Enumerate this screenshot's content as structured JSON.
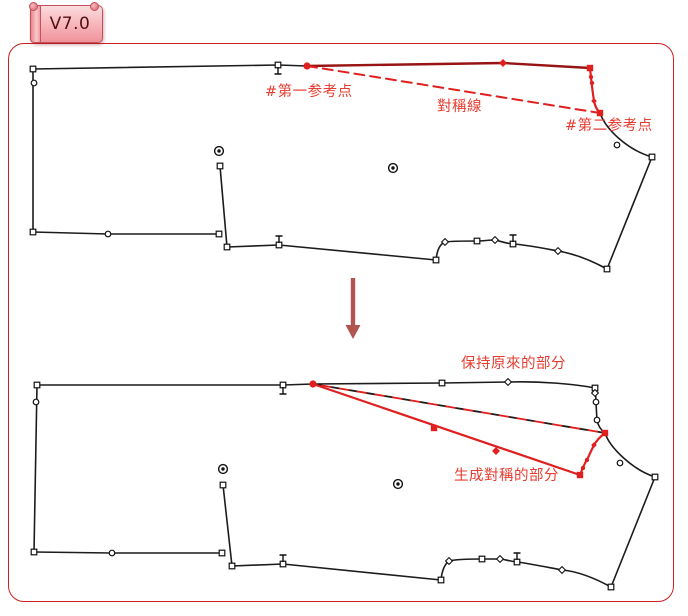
{
  "badge": {
    "version_label": "V7.0"
  },
  "diagram": {
    "top_pattern": {
      "first_reference_point_label": "#第一参考点",
      "symmetry_line_label": "對稱線",
      "second_reference_point_label": "#第二参考点"
    },
    "bottom_pattern": {
      "keep_original_label": "保持原來的部分",
      "generated_symmetric_label": "生成對稱的部分"
    }
  },
  "colors": {
    "frame_border": "#ce2020",
    "annotation_text": "#e73c30",
    "red_line": "#e01f1f",
    "dark_red_line": "#981414",
    "black_line": "#1c1c1c",
    "arrow": "#b15551",
    "badge_border": "#c4505c",
    "badge_text": "#521015",
    "badge_fill_top": "#fbdcde",
    "badge_fill_bottom": "#f0949b"
  }
}
